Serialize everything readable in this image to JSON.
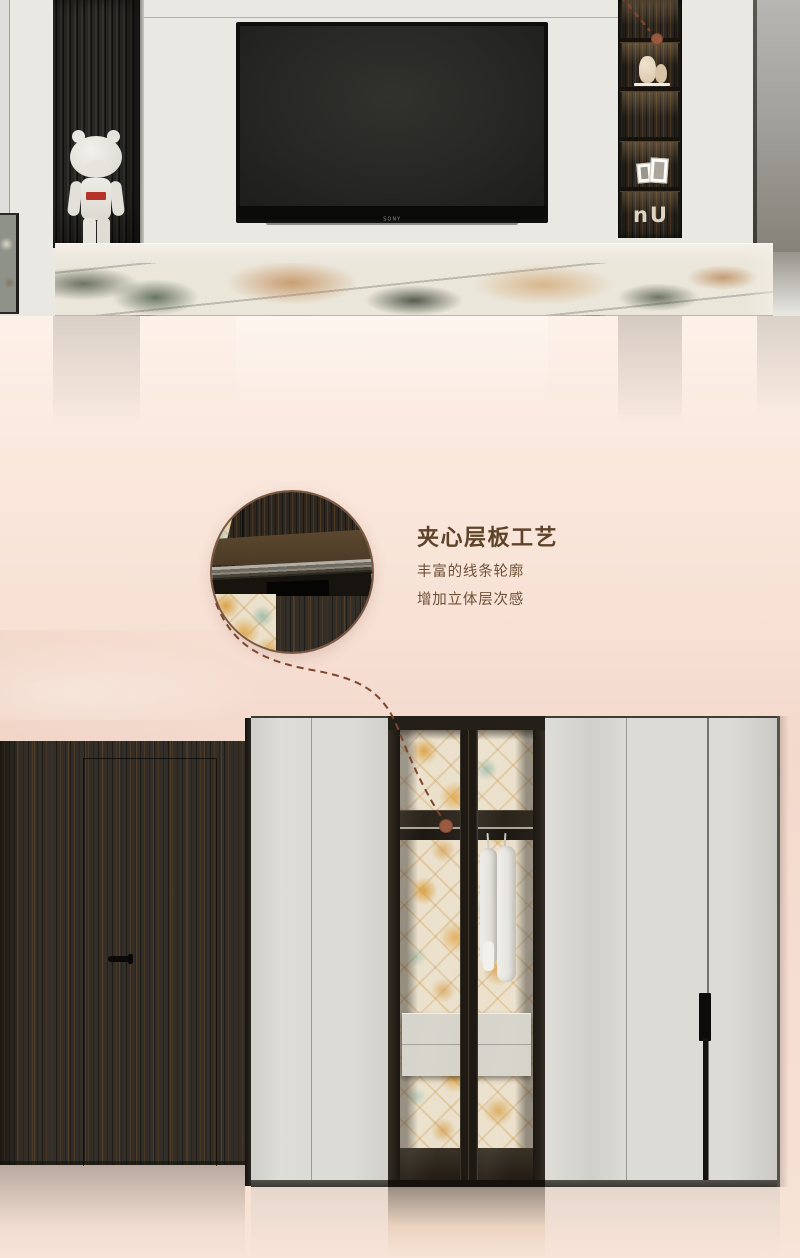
{
  "callout": {
    "title": "夹心层板工艺",
    "subtitle_line1": "丰富的线条轮廓",
    "subtitle_line2": "增加立体层次感",
    "title_color": "#5d4329",
    "subtitle_color": "#6c5137",
    "leader_line_color": "#7d452e",
    "dot_color": "#9a5a41"
  },
  "tv_wall": {
    "tv_brand": "SONY",
    "figure_logo": "Supreme",
    "shelf_decor_letters": "nU"
  },
  "palette": {
    "background_pink": "#fae7dc",
    "wall_light_gray": "#e9e8e3",
    "wardrobe_door_gray": "#dcdbd5",
    "dark_wood": "#332f28",
    "glass_frame": "#241f19",
    "wallpaper_orange": "#d8962d",
    "wallpaper_teal": "#8ab29e",
    "marble_base": "#ebe6da",
    "copper_accent": "#9a5a41"
  }
}
